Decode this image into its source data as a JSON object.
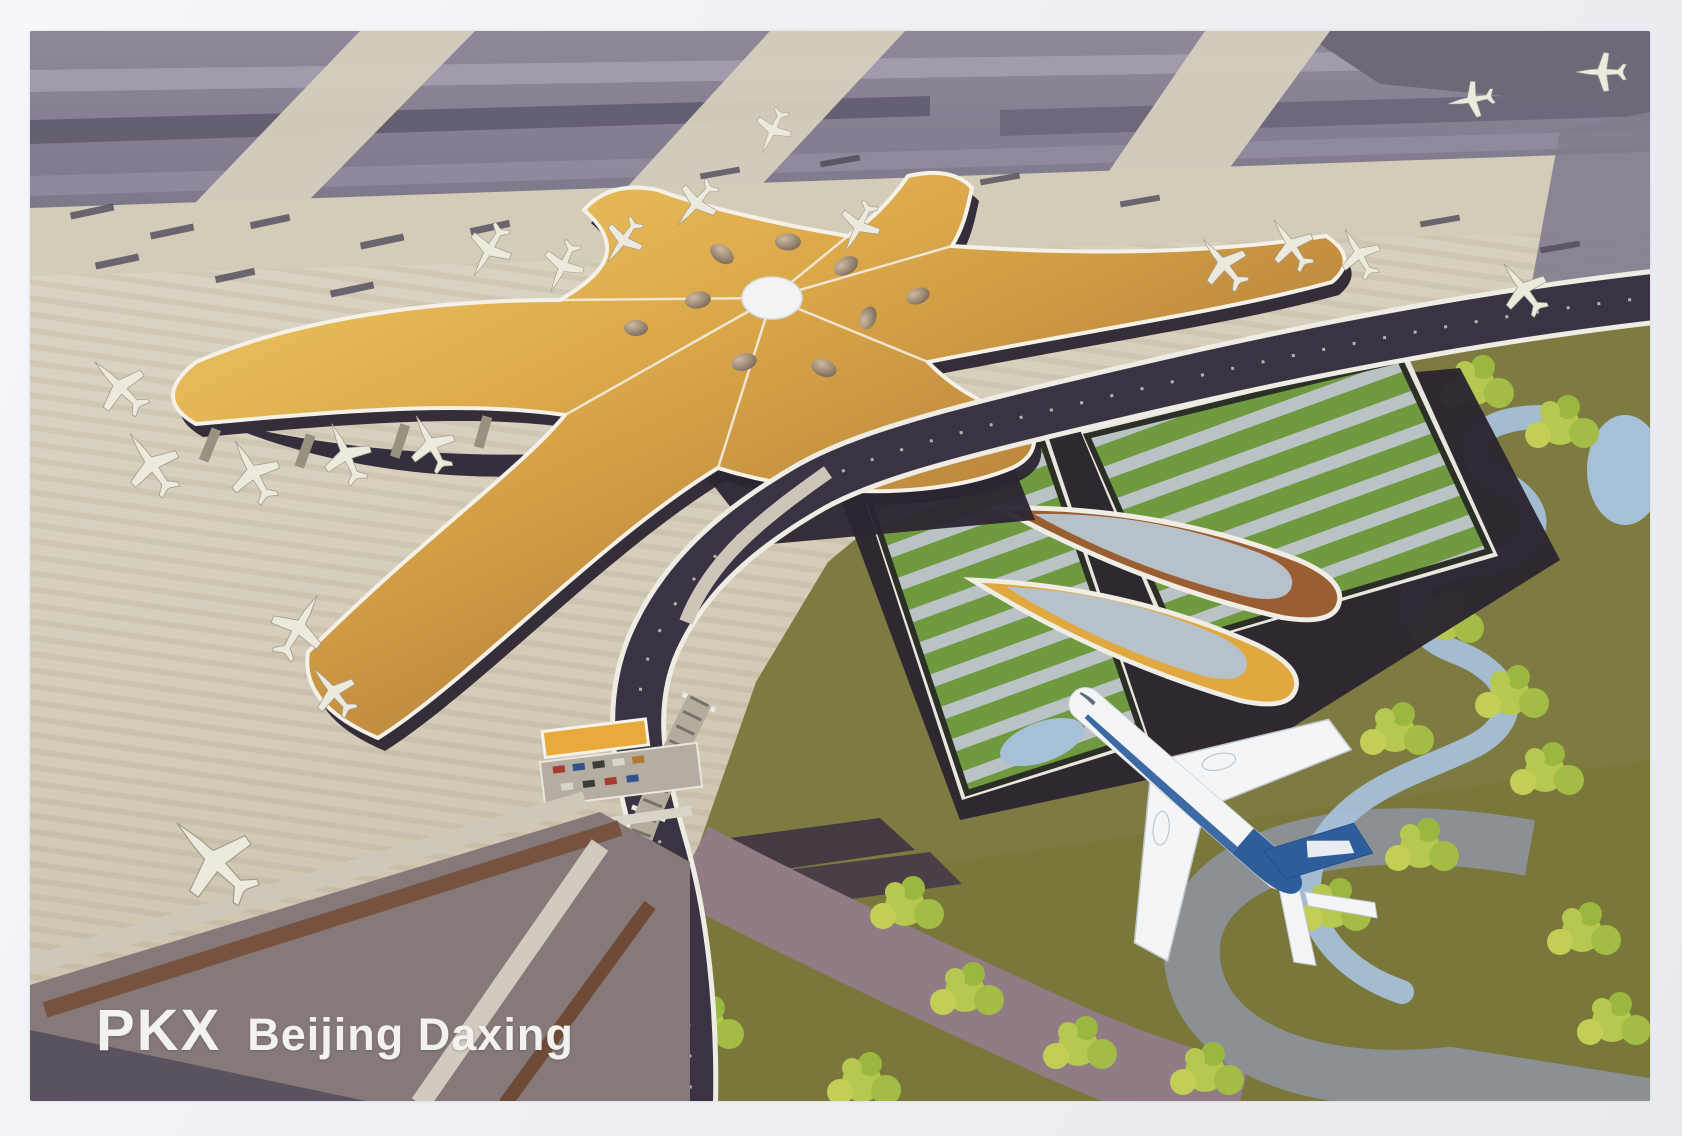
{
  "postcard": {
    "caption": {
      "code": "PKX",
      "name": "Beijing Daxing"
    },
    "alt": "Aerial rendering of Beijing Daxing International Airport: golden starfish-shaped terminal with radiating concourses, parked white aircraft on beige aprons, purple-grey runways behind, green-roofed ground transport buildings, winding blue river and landscaped roads, and a white-and-blue airliner flying over the approach.",
    "colors": {
      "border": "#eef0f4",
      "apron": "#d8d1bf",
      "runway": "#7b7487",
      "roof_gold_light": "#f2cd67",
      "roof_gold_dark": "#9a6a2c",
      "terminal_base_dark": "#2c2531",
      "green_roof": "#6f9a40",
      "roof_stripe": "#b9c2c4",
      "grass_olive": "#7e7b42",
      "tree_green": "#b6c84f",
      "river_blue": "#a6c0d8",
      "plane_white": "#f3f5f7",
      "plane_blue": "#2e5d9c",
      "caption_text": "#f3f2ef"
    }
  }
}
